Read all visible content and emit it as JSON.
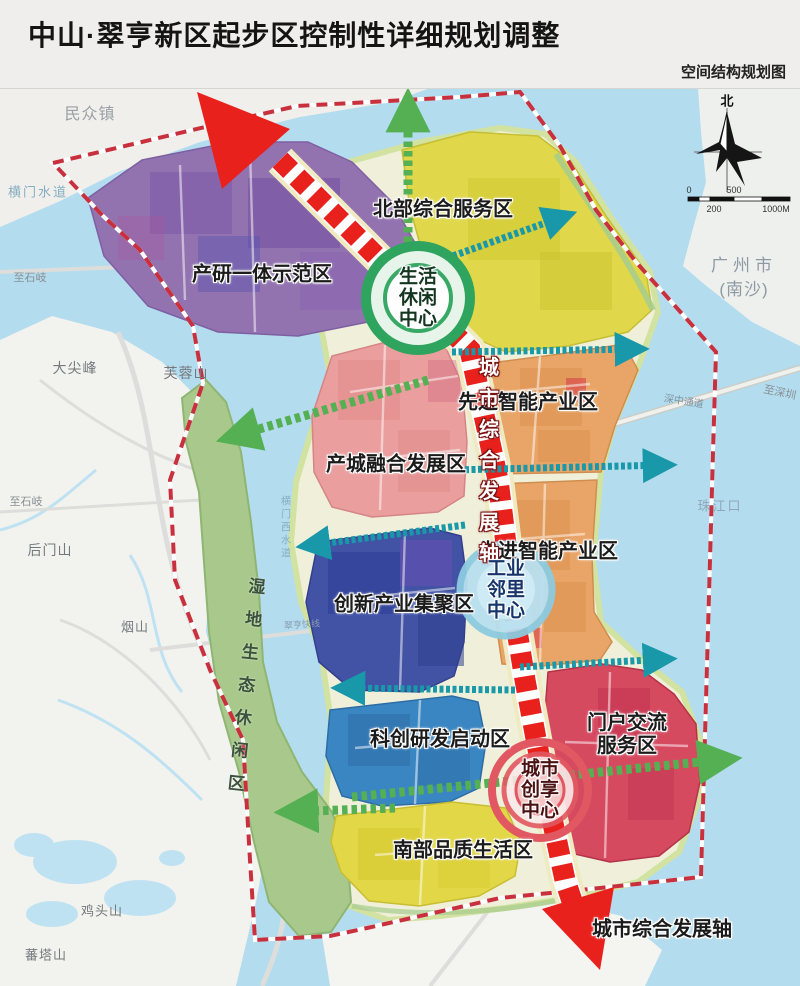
{
  "header": {
    "title": "中山·翠亨新区起步区控制性详细规划调整",
    "subtitle": "空间结构规划图"
  },
  "map": {
    "zones": {
      "chanyan": "产研一体示范区",
      "beibu": "北部综合服务区",
      "xianjin_north": "先进智能产业区",
      "xianjin_south": "先进智能产业区",
      "chancheng": "产城融合发展区",
      "chuangxin": "创新产业集聚区",
      "kechuang": "科创研发启动区",
      "menhu_line1": "门户交流",
      "menhu_line2": "服务区",
      "nanbu": "南部品质生活区",
      "shidi": "湿地生态休闲区"
    },
    "centers": {
      "life": [
        "生活",
        "休闲",
        "中心"
      ],
      "industry": [
        "工业",
        "邻里",
        "中心"
      ],
      "city": [
        "城市",
        "创享",
        "中心"
      ]
    },
    "axis": {
      "vertical_label": "城市综合发展轴",
      "bottom_label": "城市综合发展轴"
    },
    "places": {
      "minzhong": "民众镇",
      "hengmen_channel": "横门水道",
      "dajianfeng": "大尖峰",
      "furongshan": "芙蓉山",
      "zhishiqi_north": "至石岐",
      "zhishiqi_south": "至石岐",
      "houmenshan": "后门山",
      "yanshan": "烟山",
      "jitoushan": "鸡头山",
      "fantashan": "蕃塔山",
      "guangzhou_line1": "广州市",
      "guangzhou_line2": "(南沙)",
      "zhujiangkou": "珠江口",
      "shenzhong_corridor": "深中通道",
      "zhishenzhen": "至深圳",
      "hengmenxi_channel": "横门西水道",
      "cuiheng_express": "翠亨快线"
    },
    "compass": {
      "north": "北"
    },
    "scalebar": {
      "zero": "0",
      "mid": "500",
      "low_left": "200",
      "end": "1000M"
    }
  },
  "colors": {
    "water": "#b3dcee",
    "zone_chanyan": "#9273b0",
    "zone_beibu": "#e0d84a",
    "zone_xianjin": "#e9a567",
    "zone_chancheng": "#eb9e9e",
    "zone_chuangxin": "#4253a6",
    "zone_kechuang": "#3a86c2",
    "zone_menhu": "#d64a60",
    "zone_nanbu": "#e2d747",
    "wetland": "#a9c98c",
    "axis_red": "#e8211d",
    "boundary_red": "#c8303e",
    "teal_arrow": "#1898a8",
    "green_arrow": "#54b052",
    "life_center_green": "#2fa45e",
    "industry_center_blue": "#8ccbe0",
    "city_center_red": "#e25862"
  }
}
